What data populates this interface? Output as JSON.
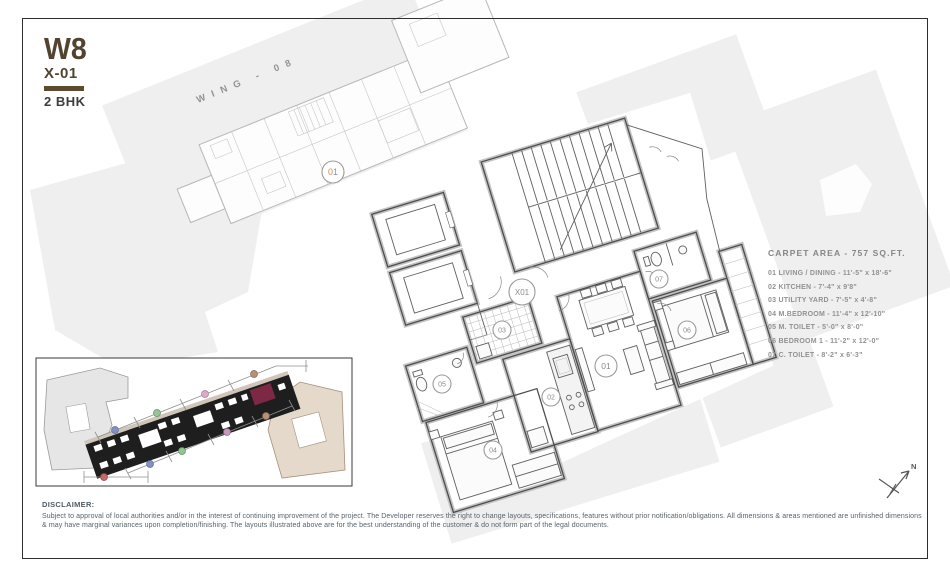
{
  "title": {
    "block": "W8",
    "unit": "X-01",
    "type": "2 BHK"
  },
  "wing_label": "WING - 08",
  "context_plan": {
    "unit_digit_1": "0",
    "unit_digit_2": "1"
  },
  "plan": {
    "core_label": "X01",
    "rooms": {
      "r01": "01",
      "r02": "02",
      "r03": "03",
      "r04": "04",
      "r05": "05",
      "r06": "06",
      "r07": "07"
    }
  },
  "legend": {
    "header": "CARPET AREA - 757 SQ.FT.",
    "items": [
      "01 LIVING / DINING - 11'-5\" x 18'-6\"",
      "02 KITCHEN - 7'-4\" x 9'8\"",
      "03 UTILITY YARD - 7'-5\" x 4'-8\"",
      "04 M.BEDROOM - 11'-4\" x 12'-10\"",
      "05 M. TOILET - 5'-0\" x 8'-0\"",
      "06 BEDROOM 1 - 11'-2\" x 12'-0\"",
      "07 C. TOILET - 8'-2\" x 6'-3\""
    ]
  },
  "compass": {
    "label": "N"
  },
  "disclaimer": {
    "heading": "DISCLAIMER:",
    "line1": "Subject to approval of local authorities and/or in the interest of continuing improvement of the project. The Developer reserves the right to change layouts, specifications, features without prior notification/obligations. All dimensions & areas mentioned are unfinished dimensions",
    "line2": "& may have marginal variances upon completion/finishing. The layouts illustrated above are for the best understanding of the customer & do not form part of the legal documents."
  },
  "colors": {
    "accent_brown": "#5d4a2f",
    "highlight_maroon": "#7d2946",
    "context_tan": "#e5d9cb"
  }
}
